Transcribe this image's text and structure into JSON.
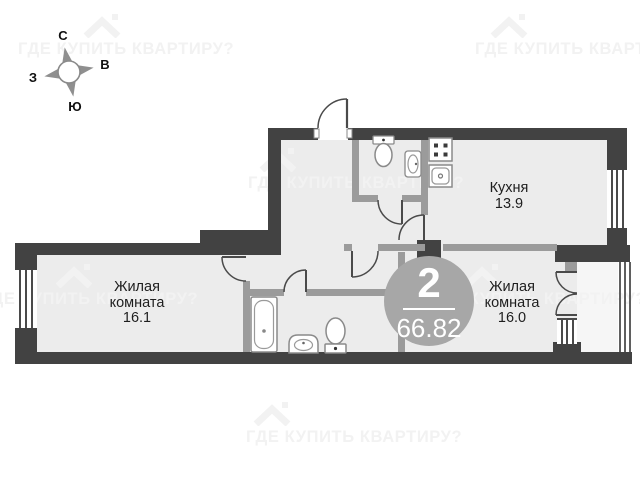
{
  "compass": {
    "north": "С",
    "east": "В",
    "south": "Ю",
    "west": "З"
  },
  "watermark": {
    "text": "ГДЕ КУПИТЬ КВАРТИРУ?"
  },
  "badge": {
    "room_count": "2",
    "total_area": "66.82"
  },
  "rooms": {
    "living_room_1": {
      "name": "Жилая комната",
      "area": "16.1"
    },
    "kitchen": {
      "name": "Кухня",
      "area": "13.9"
    },
    "living_room_2": {
      "name": "Жилая комната",
      "area": "16.0"
    }
  },
  "colors": {
    "outer_wall": "#424242",
    "inner_wall": "#9b9b9b",
    "floor": "#ececec",
    "badge_fill": "#a7a7a7",
    "watermark": "#f2f2f2"
  }
}
